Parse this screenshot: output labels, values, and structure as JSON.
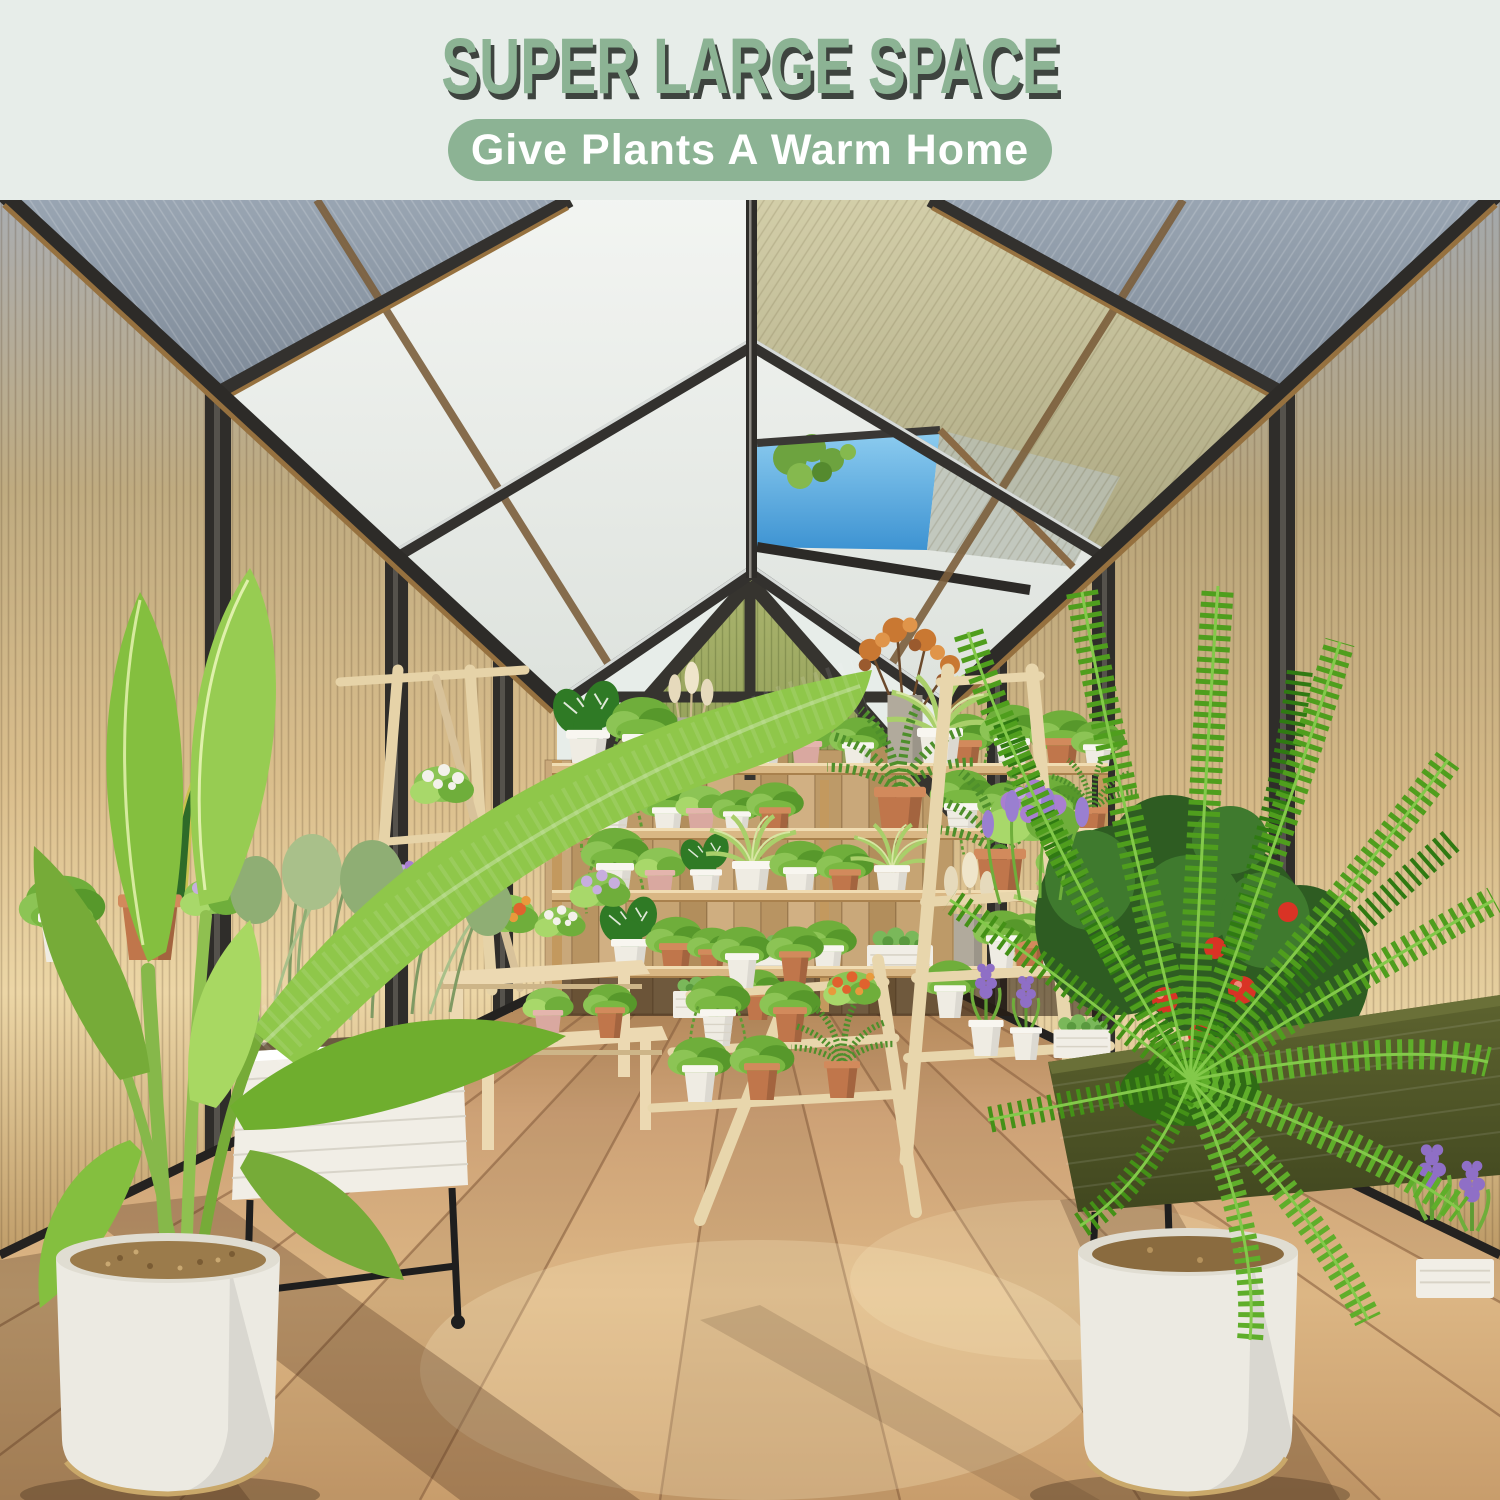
{
  "header": {
    "title": "SUPER LARGE SPACE",
    "tagline": "Give Plants A Warm Home"
  },
  "palette": {
    "page_background": "#e7ede9",
    "title_green": "#8cb394",
    "title_shadow": "#3e443f",
    "tagline_background": "#8cb394",
    "tagline_text": "#ffffff",
    "frame_dark": "#2e2c29",
    "frame_bronze": "#96713f",
    "frame_silver": "#d7dbd9",
    "roof_blue_gray": "#8f9aa7",
    "roof_frosted_white": "#eef1ee",
    "sky_blue": "#4f9fd8",
    "wall_amber": "#d8bc8a",
    "gable_green": "#9aa761",
    "fence_wood": "#c3a071",
    "shelf_wood": "#e2c28e",
    "floor_wood": "#cfa574",
    "cream_wood": "#ead9b4",
    "planter_white": "#f1eee6",
    "planter_olive": "#545a2c",
    "foliage_green": "#6fae2e",
    "pot_terracotta": "#c0764b",
    "flower_purple": "#a97fd0",
    "tomato_red": "#d93325"
  }
}
